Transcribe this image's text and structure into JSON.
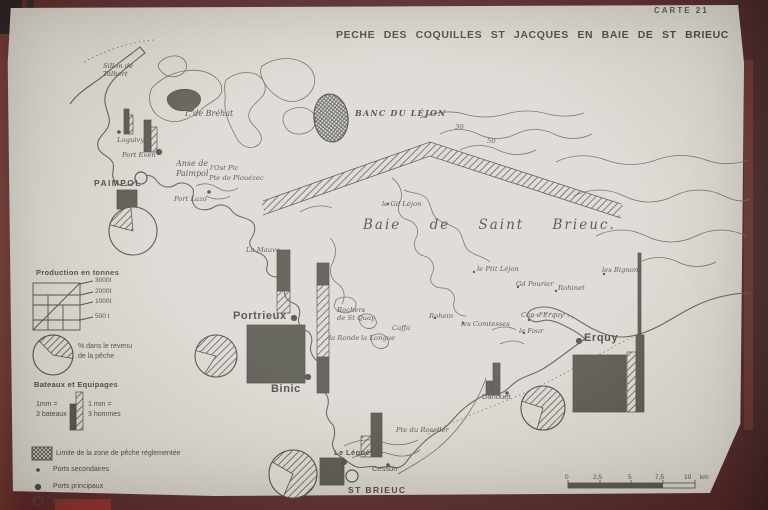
{
  "header": {
    "carte_label": "CARTE 21",
    "title": "PECHE DES COQUILLES ST JACQUES EN BAIE DE ST BRIEUC"
  },
  "colors": {
    "photo_mat": "#44100f",
    "paper": "#d7d4ce",
    "ink": "#34332d",
    "solid_fill": "#3f3d36",
    "bright_red_edge": "#7e1717"
  },
  "legend": {
    "production": {
      "title": "Production en tonnes",
      "ticks": [
        "3000t",
        "2000t",
        "1000t",
        "500 t"
      ]
    },
    "revenue_pie_label": "% dans le revenu\nde la pêche",
    "crews": {
      "title": "Bateaux et Equipages",
      "boats_label": "1mm =\n3 bateaux",
      "men_label": "1 mm =\n3 hommes"
    },
    "zone_label": "Limite de la zone de pêche réglementée",
    "secondary_ports_label": "Ports secondaires",
    "main_ports_label": "Ports principaux",
    "quartiers_label": "Quartiers"
  },
  "scalebar": {
    "ticks": [
      "0",
      "2,5",
      "5",
      "7,5",
      "10"
    ],
    "unit": "km"
  },
  "map": {
    "sea_label": "Baie de Saint Brieuc.",
    "banc_label": "BANC DU LÉJON",
    "labels": [
      {
        "text": "Sillon de\nTalbert",
        "x": 103,
        "y": 62,
        "cls": "tiny"
      },
      {
        "text": "I. de Bréhat",
        "x": 185,
        "y": 109,
        "cls": "small-i"
      },
      {
        "text": "Loguivy",
        "x": 117,
        "y": 136,
        "cls": "tiny"
      },
      {
        "text": "Port Even",
        "x": 122,
        "y": 151,
        "cls": "tiny"
      },
      {
        "text": "Anse  de\n  Paimpol",
        "x": 176,
        "y": 159,
        "cls": "small-i"
      },
      {
        "text": "l'Ost Pic",
        "x": 210,
        "y": 164,
        "cls": "tiny"
      },
      {
        "text": "Pte de Plouézec",
        "x": 209,
        "y": 174,
        "cls": "tiny"
      },
      {
        "text": "Port Lazo",
        "x": 174,
        "y": 195,
        "cls": "tiny"
      },
      {
        "text": "PAIMPOL",
        "x": 94,
        "y": 178,
        "cls": "city"
      },
      {
        "text": "BANC DU LÉJON",
        "x": 355,
        "y": 108,
        "cls": "banc"
      },
      {
        "text": "le Gd Léjon",
        "x": 382,
        "y": 200,
        "cls": "tiny"
      },
      {
        "text": "Baie   de   Saint   Brieuc.",
        "x": 363,
        "y": 217,
        "cls": "sea"
      },
      {
        "text": "La Mauve",
        "x": 246,
        "y": 246,
        "cls": "tiny"
      },
      {
        "text": "Portrieux",
        "x": 233,
        "y": 310,
        "cls": "port-lg"
      },
      {
        "text": "Binic",
        "x": 271,
        "y": 383,
        "cls": "port-lg"
      },
      {
        "text": "Rochers\nde St Quay",
        "x": 337,
        "y": 306,
        "cls": "tiny"
      },
      {
        "text": "Caffa",
        "x": 392,
        "y": 324,
        "cls": "tiny"
      },
      {
        "text": "la Ronde",
        "x": 329,
        "y": 334,
        "cls": "tiny"
      },
      {
        "text": "la Longue",
        "x": 361,
        "y": 334,
        "cls": "tiny"
      },
      {
        "text": "Rohein",
        "x": 429,
        "y": 312,
        "cls": "tiny"
      },
      {
        "text": "le Ptit Léjon",
        "x": 477,
        "y": 265,
        "cls": "tiny"
      },
      {
        "text": "Gd Pourier",
        "x": 516,
        "y": 280,
        "cls": "tiny"
      },
      {
        "text": "Rohinet",
        "x": 558,
        "y": 284,
        "cls": "tiny"
      },
      {
        "text": "les Bignons",
        "x": 602,
        "y": 266,
        "cls": "tiny"
      },
      {
        "text": "les Comtesses",
        "x": 461,
        "y": 320,
        "cls": "tiny"
      },
      {
        "text": "Cap d'Erquy",
        "x": 521,
        "y": 311,
        "cls": "tiny"
      },
      {
        "text": "le Four",
        "x": 519,
        "y": 327,
        "cls": "tiny"
      },
      {
        "text": "Erquy",
        "x": 584,
        "y": 332,
        "cls": "port-lg"
      },
      {
        "text": "Dahouet",
        "x": 482,
        "y": 392,
        "cls": "small"
      },
      {
        "text": "Pte du Roselier",
        "x": 396,
        "y": 426,
        "cls": "tiny"
      },
      {
        "text": "Le Légué",
        "x": 334,
        "y": 448,
        "cls": "port"
      },
      {
        "text": "Cesson",
        "x": 372,
        "y": 464,
        "cls": "small"
      },
      {
        "text": "ST BRIEUC",
        "x": 348,
        "y": 485,
        "cls": "city"
      },
      {
        "text": "30",
        "x": 455,
        "y": 123,
        "cls": "tiny"
      },
      {
        "text": "50",
        "x": 487,
        "y": 137,
        "cls": "tiny"
      }
    ],
    "markers": [
      {
        "type": "quartier",
        "name": "Paimpol",
        "x": 141,
        "y": 178
      },
      {
        "type": "quartier",
        "name": "St Brieuc",
        "x": 352,
        "y": 476
      },
      {
        "type": "principal",
        "name": "Portrieux",
        "x": 294,
        "y": 318
      },
      {
        "type": "principal",
        "name": "Binic",
        "x": 308,
        "y": 377
      },
      {
        "type": "principal",
        "name": "Erquy",
        "x": 579,
        "y": 341
      },
      {
        "type": "principal",
        "name": "Le Légué",
        "x": 344,
        "y": 462
      },
      {
        "type": "principal",
        "name": "Port Even",
        "x": 159,
        "y": 152
      },
      {
        "type": "secondaire",
        "name": "Loguivy",
        "x": 119,
        "y": 132
      },
      {
        "type": "secondaire",
        "name": "Port Lazo",
        "x": 209,
        "y": 192
      },
      {
        "type": "secondaire",
        "name": "Cesson",
        "x": 388,
        "y": 465
      },
      {
        "type": "secondaire",
        "name": "Dahouet",
        "x": 507,
        "y": 393
      }
    ],
    "production_squares": [
      {
        "port": "Paimpol",
        "x": 117,
        "y": 190,
        "w": 20,
        "h": 19
      },
      {
        "port": "Portrieux-Binic",
        "x": 247,
        "y": 325,
        "w": 58,
        "h": 58
      },
      {
        "port": "St Brieuc",
        "x": 320,
        "y": 458,
        "w": 24,
        "h": 27
      },
      {
        "port": "Erquy",
        "x": 573,
        "y": 355,
        "w": 53,
        "h": 57
      }
    ],
    "bars": [
      {
        "port": "Loguivy",
        "x": 124,
        "y": 109,
        "w": 5,
        "h": 25,
        "f": "solid"
      },
      {
        "port": "Loguivy",
        "x": 129,
        "y": 115,
        "w": 4,
        "h": 19,
        "f": "hatch"
      },
      {
        "port": "Port Even",
        "x": 144,
        "y": 120,
        "w": 7,
        "h": 32,
        "f": "solid"
      },
      {
        "port": "Port Even",
        "x": 151,
        "y": 127,
        "w": 6,
        "h": 25,
        "f": "hatch"
      },
      {
        "port": "Portrieux",
        "x": 277,
        "y": 250,
        "w": 13,
        "h": 41,
        "f": "solid"
      },
      {
        "port": "Portrieux",
        "x": 277,
        "y": 291,
        "w": 13,
        "h": 22,
        "f": "hatch"
      },
      {
        "port": "Binic",
        "x": 317,
        "y": 263,
        "w": 12,
        "h": 22,
        "f": "solid"
      },
      {
        "port": "Binic",
        "x": 317,
        "y": 285,
        "w": 12,
        "h": 72,
        "f": "hatch"
      },
      {
        "port": "Binic",
        "x": 317,
        "y": 357,
        "w": 12,
        "h": 36,
        "f": "solid"
      },
      {
        "port": "Le Légué",
        "x": 371,
        "y": 413,
        "w": 11,
        "h": 44,
        "f": "solid"
      },
      {
        "port": "Le Légué",
        "x": 361,
        "y": 436,
        "w": 10,
        "h": 21,
        "f": "hatch"
      },
      {
        "port": "Dahouet",
        "x": 493,
        "y": 363,
        "w": 7,
        "h": 32,
        "f": "solid"
      },
      {
        "port": "Dahouet",
        "x": 486,
        "y": 381,
        "w": 7,
        "h": 14,
        "f": "solid"
      },
      {
        "port": "Erquy",
        "x": 627,
        "y": 352,
        "w": 9,
        "h": 60,
        "f": "hatch"
      },
      {
        "port": "Erquy",
        "x": 636,
        "y": 335,
        "w": 8,
        "h": 77,
        "f": "solid"
      },
      {
        "port": "Erquy",
        "x": 638,
        "y": 253,
        "w": 3,
        "h": 82,
        "f": "solid"
      },
      {
        "port": "legend-bateaux",
        "x": 70,
        "y": 404,
        "w": 6,
        "h": 26,
        "f": "solid"
      },
      {
        "port": "legend-hommes",
        "x": 76,
        "y": 392,
        "w": 7,
        "h": 38,
        "f": "hatch"
      }
    ],
    "pies": [
      {
        "port": "legend",
        "cx": 53,
        "cy": 355,
        "r": 20,
        "hatch_from": 315,
        "hatch_to": 100
      },
      {
        "port": "Paimpol",
        "cx": 133,
        "cy": 231,
        "r": 24,
        "hatch_from": 285,
        "hatch_to": 355
      },
      {
        "port": "Portrieux",
        "cx": 216,
        "cy": 356,
        "r": 21,
        "hatch_from": 285,
        "hatch_to": 213
      },
      {
        "port": "St Brieuc",
        "cx": 293,
        "cy": 474,
        "r": 24,
        "hatch_from": 300,
        "hatch_to": 203
      },
      {
        "port": "Erquy-Dahouet",
        "cx": 543,
        "cy": 408,
        "r": 22,
        "hatch_from": 288,
        "hatch_to": 196
      }
    ],
    "banc_ellipse": {
      "cx": 331,
      "cy": 118,
      "rx": 17,
      "ry": 24
    }
  }
}
